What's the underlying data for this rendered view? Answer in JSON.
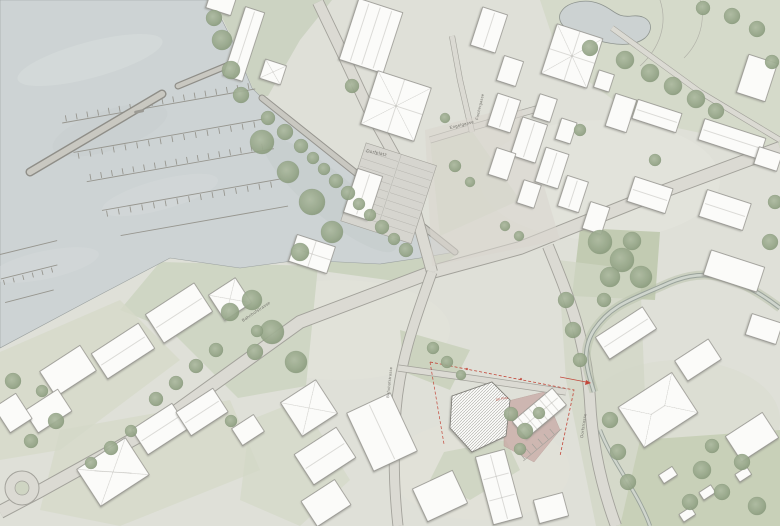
{
  "map": {
    "kind": "architectural site plan / village masterplan with lakefront marina",
    "labels": {
      "dorfplatz": "Dorfplatz",
      "engelgasse": "Engelgasse",
      "fischergasse": "Fischergasse",
      "bahnhofstrasse_upper": "Bahnhofstrasse",
      "bahnhofstrasse_lower": "Bahnhofstrasse",
      "dorfstrasse": "Dorfstrasse"
    },
    "site": {
      "annotation": "OK Platz"
    },
    "colors": {
      "water": "#cdd3d4",
      "land": "#dfe0d8",
      "green": "#cbd2bf",
      "tree": "#98a78b",
      "building": "#fbfbf9",
      "street": "#dbdad3",
      "street_edge": "#a3a29b",
      "plaza_pink": "#c8a9a5",
      "accent_red": "#c2473a"
    }
  }
}
